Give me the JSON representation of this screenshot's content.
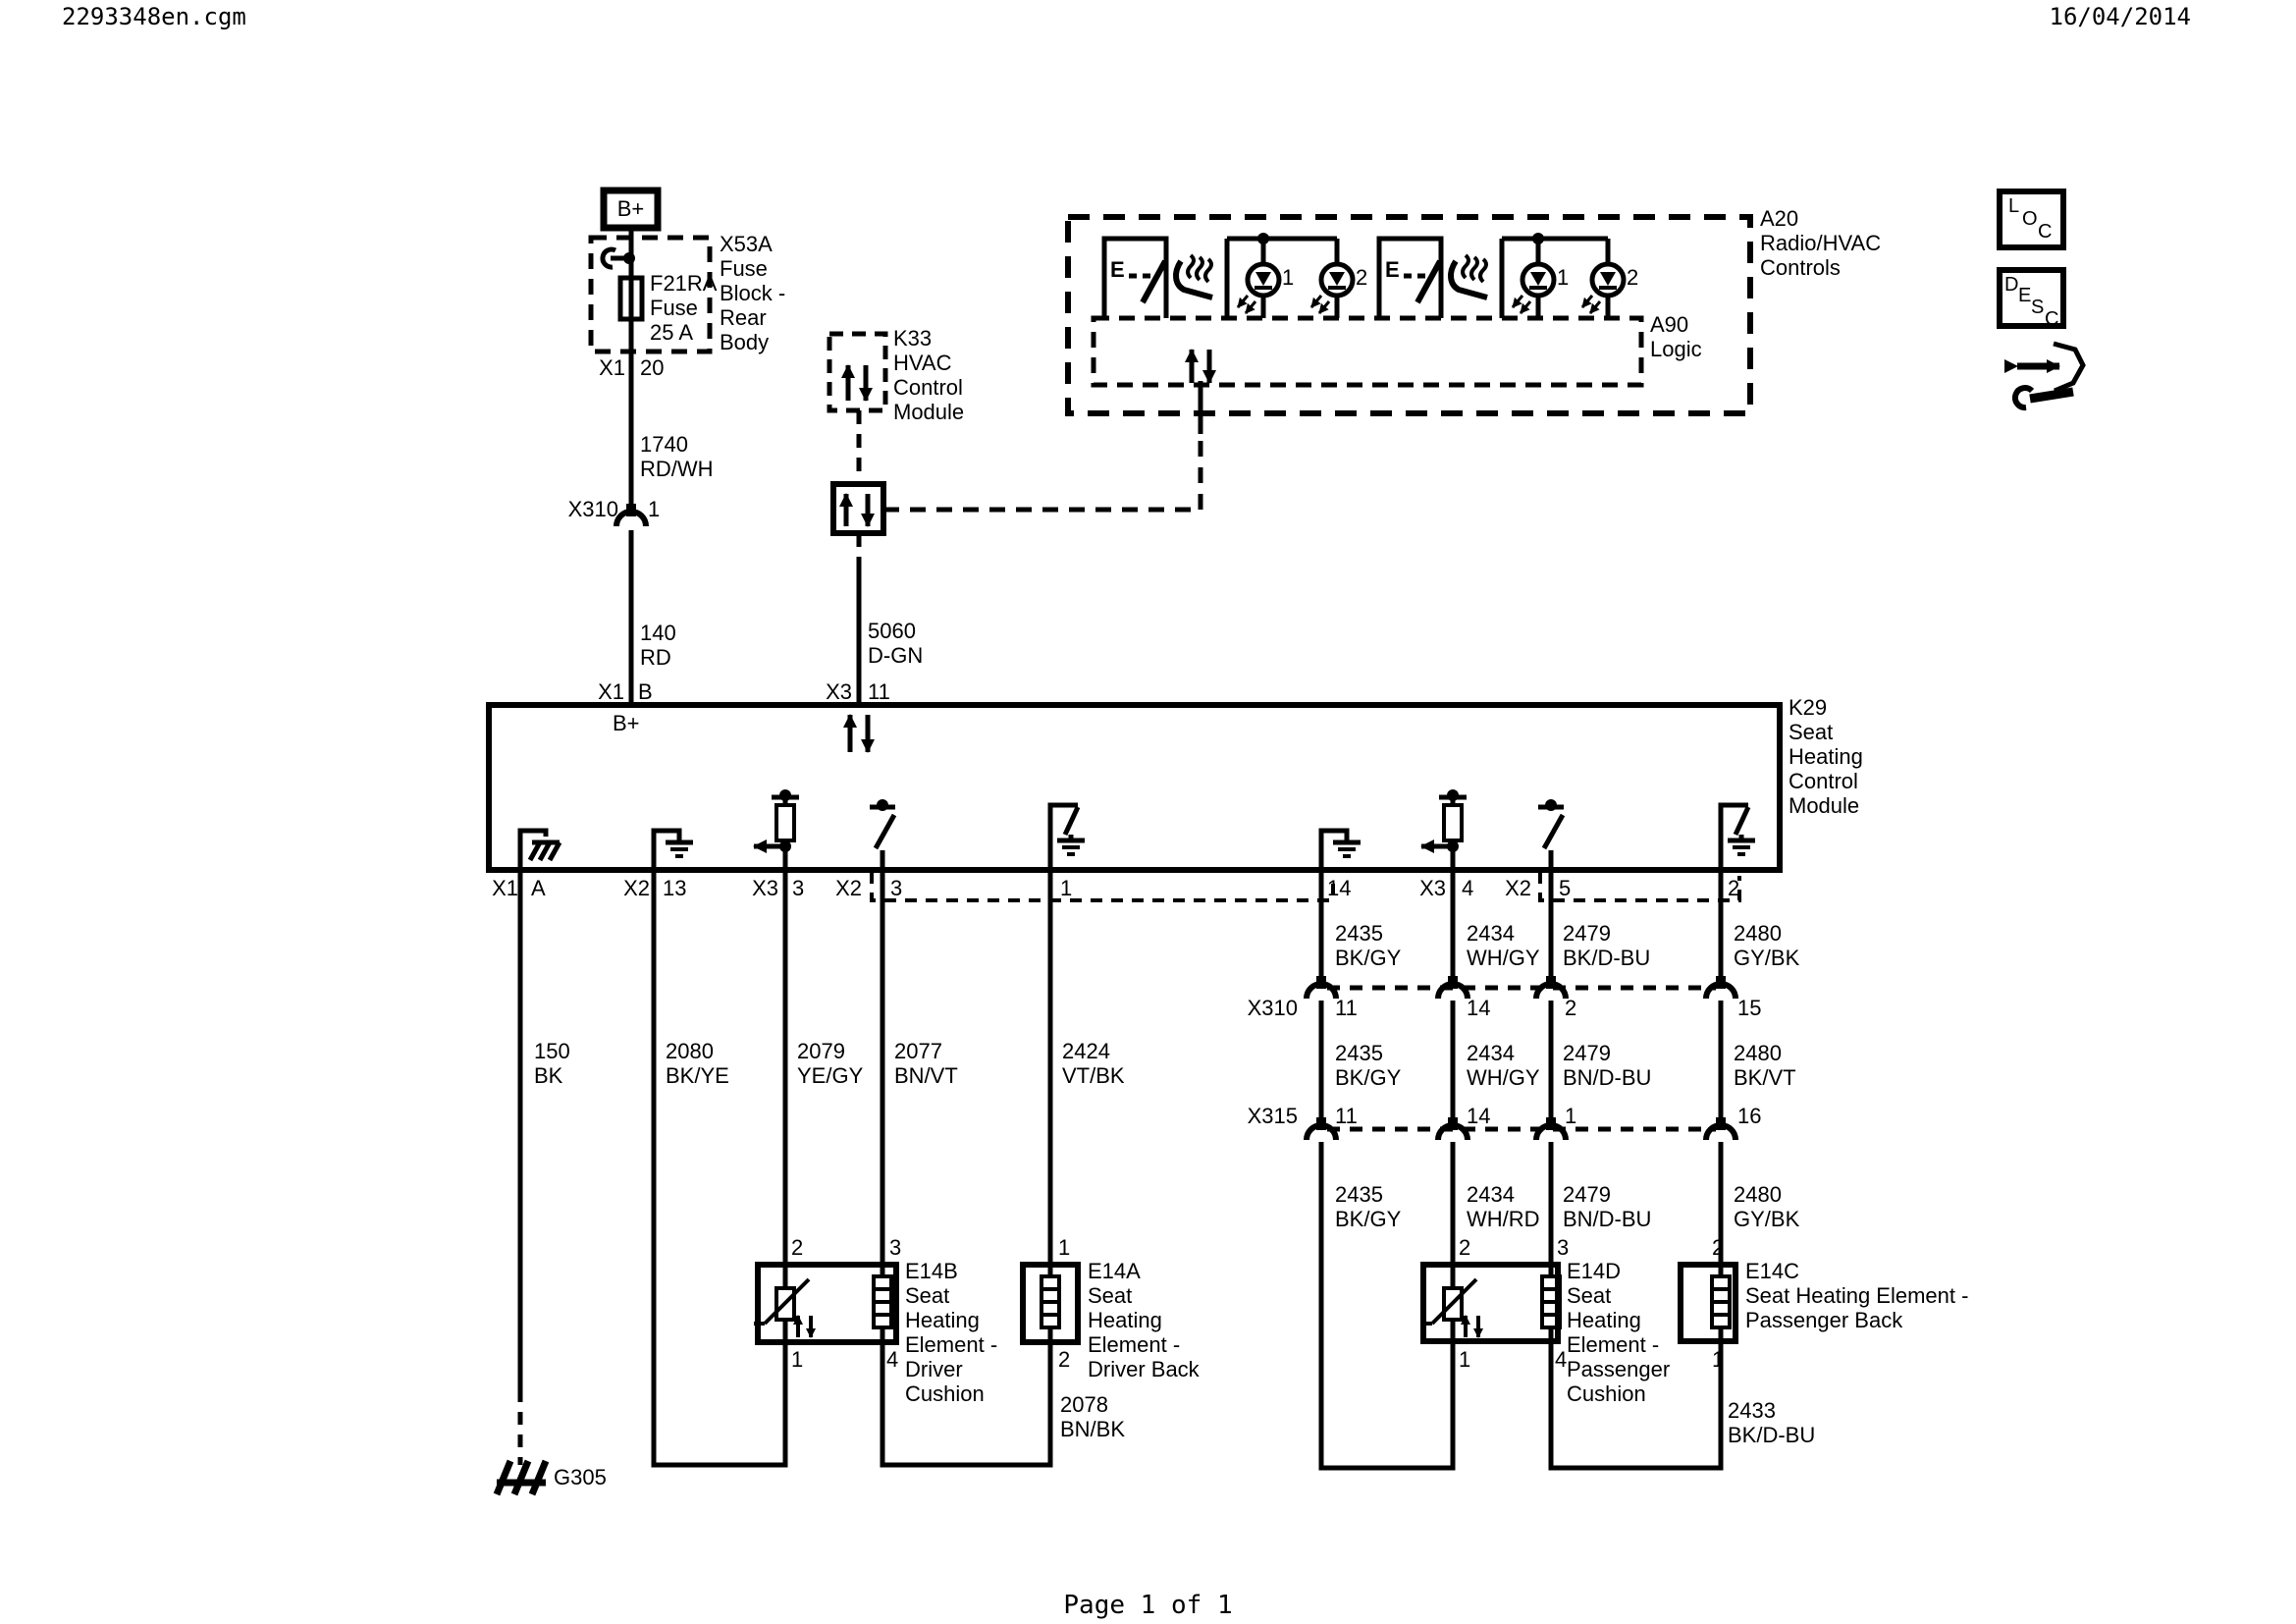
{
  "header": {
    "filename": "2293348en.cgm",
    "date": "16/04/2014"
  },
  "footer": {
    "page": "Page 1 of 1"
  },
  "battery": {
    "label": "B+"
  },
  "fuse": {
    "part": "F21RA\nFuse\n25 A",
    "block": "X53A\nFuse\nBlock -\nRear\nBody",
    "conn": "X1",
    "pin": "20"
  },
  "left_branch": {
    "wire_upper": "1740\nRD/WH",
    "conn_label": "X310",
    "conn_pin": "1",
    "wire_lower": "140\nRD",
    "module_conn": "X1",
    "module_pin": "B",
    "bus_label": "B+"
  },
  "k33": {
    "label": "K33\nHVAC\nControl\nModule"
  },
  "lin": {
    "wire": "5060\nD-GN",
    "module_conn": "X3",
    "module_pin": "11"
  },
  "a20": {
    "label": "A20\nRadio/HVAC\nControls",
    "a90": "A90\nLogic",
    "sw1_e": "E",
    "sw2_e": "E",
    "led1_1": "1",
    "led1_2": "2",
    "led2_1": "1",
    "led2_2": "2"
  },
  "k29": {
    "label": "K29\nSeat\nHeating\nControl\nModule",
    "pins": [
      {
        "conn": "X1",
        "pin": "A"
      },
      {
        "conn": "X2",
        "pin": "13"
      },
      {
        "conn": "X3",
        "pin": "3"
      },
      {
        "conn": "X2",
        "pin": "3"
      },
      {
        "conn": "",
        "pin": "1"
      },
      {
        "conn": "",
        "pin": "14"
      },
      {
        "conn": "X3",
        "pin": "4"
      },
      {
        "conn": "X2",
        "pin": "5"
      },
      {
        "conn": "",
        "pin": "2"
      }
    ]
  },
  "wires_top": [
    "150\nBK",
    "2080\nBK/YE",
    "2079\nYE/GY",
    "2077\nBN/VT",
    "2424\nVT/BK",
    "2435\nBK/GY",
    "2434\nWH/GY",
    "2479\nBK/D-BU",
    "2480\nGY/BK"
  ],
  "x310": {
    "label": "X310",
    "pins": [
      "11",
      "14",
      "2",
      "15"
    ]
  },
  "wires_mid": [
    "2435\nBK/GY",
    "2434\nWH/GY",
    "2479\nBN/D-BU",
    "2480\nBK/VT"
  ],
  "x315": {
    "label": "X315",
    "pins": [
      "11",
      "14",
      "1",
      "16"
    ]
  },
  "wires_low": [
    "2435\nBK/GY",
    "2434\nWH/RD",
    "2479\nBN/D-BU",
    "2480\nGY/BK"
  ],
  "e14b": {
    "label": "E14B\nSeat\nHeating\nElement -\nDriver\nCushion",
    "pt1": "2",
    "pt2": "3",
    "pb1": "1",
    "pb2": "4"
  },
  "e14a": {
    "label": "E14A\nSeat\nHeating\nElement -\nDriver Back",
    "pt1": "1",
    "pb1": "2"
  },
  "e14d": {
    "label": "E14D\nSeat\nHeating\nElement -\nPassenger\nCushion",
    "pt1": "2",
    "pt2": "3",
    "pb1": "1",
    "pb2": "4"
  },
  "e14c": {
    "label": "E14C\nSeat Heating Element -\nPassenger Back",
    "pt1": "2",
    "pb1": "1"
  },
  "bottom": {
    "w2078": "2078\nBN/BK",
    "w2433": "2433\nBK/D-BU",
    "ground": "G305"
  },
  "icons": {
    "loc": [
      "L",
      "O",
      "C"
    ],
    "desc": [
      "D",
      "E",
      "S",
      "C"
    ]
  },
  "colors": {
    "ink": "#000000",
    "paper": "#ffffff"
  }
}
